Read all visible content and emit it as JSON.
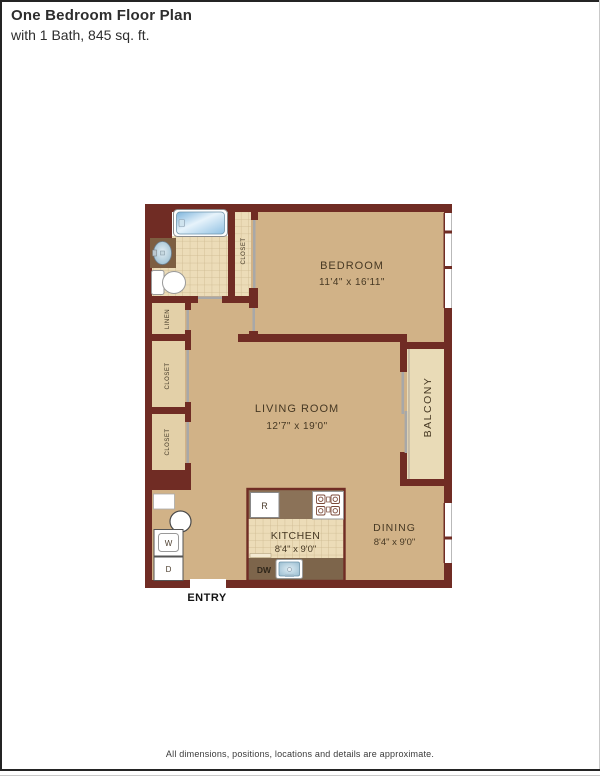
{
  "header": {
    "title": "One Bedroom Floor Plan",
    "subtitle": "with 1 Bath, 845 sq. ft."
  },
  "plan": {
    "rooms": {
      "bedroom": {
        "name": "BEDROOM",
        "dims": "11'4\" x 16'11\""
      },
      "living": {
        "name": "LIVING ROOM",
        "dims": "12'7\" x 19'0\""
      },
      "kitchen": {
        "name": "KITCHEN",
        "dims": "8'4\" x 9'0\""
      },
      "dining": {
        "name": "DINING",
        "dims": "8'4\" x 9'0\""
      },
      "balcony": {
        "name": "BALCONY"
      }
    },
    "closets": {
      "top": "CLOSET",
      "linen": "LINEN",
      "mid": "CLOSET",
      "lower": "CLOSET"
    },
    "entry_label": "ENTRY",
    "appliances": {
      "refrigerator": "R",
      "washer": "W",
      "dryer": "D",
      "dishwasher": "DW"
    }
  },
  "footer": {
    "disclaimer": "All dimensions, positions, locations and details are approximate."
  },
  "colors": {
    "wall": "#702c24",
    "floor": "#d1b287",
    "tile": "#ecdcb8",
    "tile_grid": "#cdb88f",
    "closet_floor": "#e3d0a8",
    "balcony_floor": "#e9dbb7",
    "counter_top": "#8b7258",
    "counter_bottom": "#7d654b",
    "door_gray": "#a8a8a8",
    "tub_blue": "#8fc0e2",
    "sink_blue": "#9fc6da"
  }
}
